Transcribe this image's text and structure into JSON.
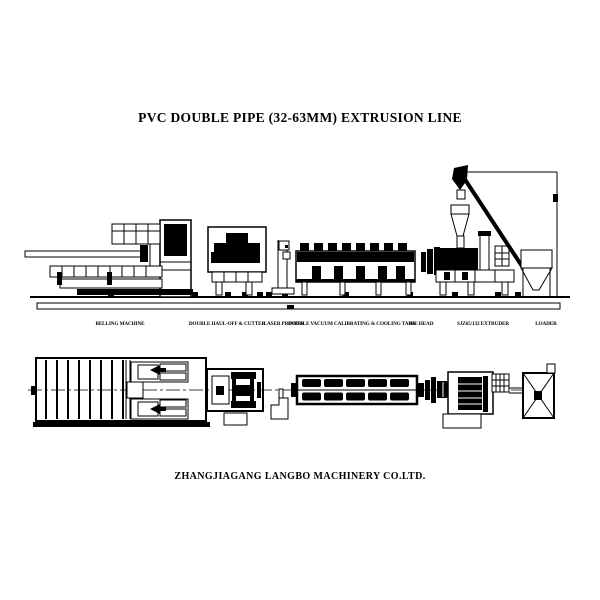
{
  "title": "PVC DOUBLE PIPE (32-63MM) EXTRUSION LINE",
  "company": "ZHANGJIAGANG LANGBO MACHINERY CO.LTD.",
  "machine_labels": [
    {
      "label": "BELLING MACHINE"
    },
    {
      "label": "DOUBLE HAUL-OFF & CUTTER"
    },
    {
      "label": "LASER PRINTER"
    },
    {
      "label": "DOUBLE VACUUM CALIBRATING & COOLING TANK"
    },
    {
      "label": "DIE HEAD"
    },
    {
      "label": "SJZ65/132 EXTRUDER"
    },
    {
      "label": "LOADER"
    }
  ],
  "colors": {
    "ink": "#000000",
    "paper": "#ffffff"
  }
}
